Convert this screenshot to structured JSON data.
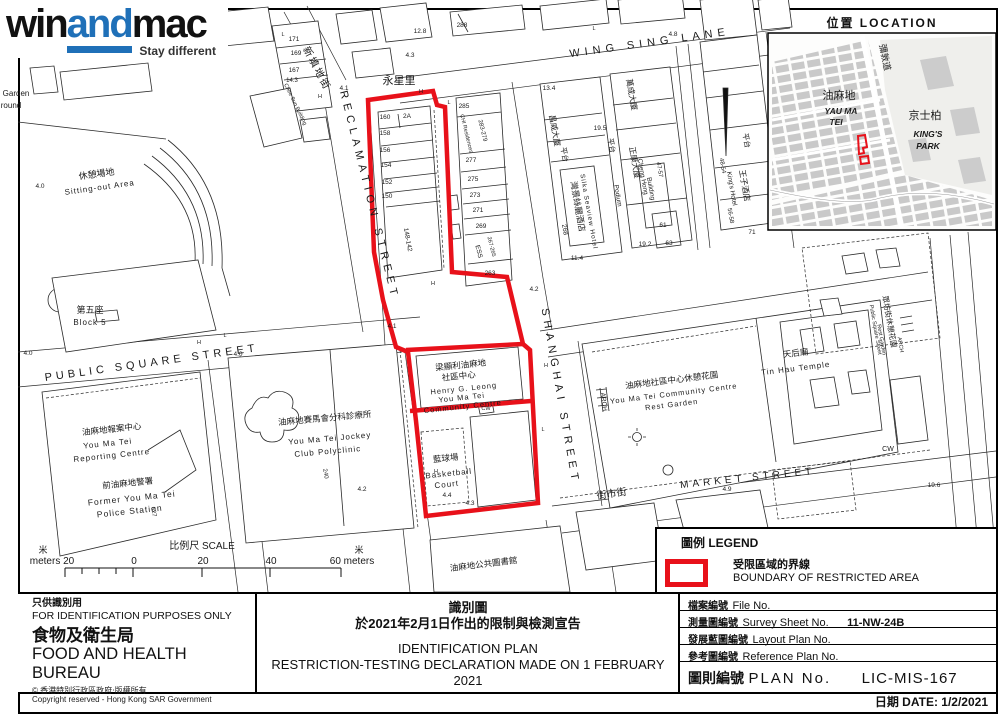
{
  "logo": {
    "win": "win",
    "and": "and",
    "mac": "mac",
    "tagline": "Stay different",
    "accent": "#1f70b8"
  },
  "inset": {
    "title": "位置  LOCATION",
    "labels": [
      {
        "t": "油麻地",
        "x": 839,
        "y": 99,
        "s": 11
      },
      {
        "t": "YAU  MA",
        "x": 841,
        "y": 114,
        "s": 8.5,
        "i": 1,
        "w": 1
      },
      {
        "t": "TEI",
        "x": 836,
        "y": 125,
        "s": 8.5,
        "i": 1,
        "w": 1
      },
      {
        "t": "京士柏",
        "x": 925,
        "y": 119,
        "s": 11
      },
      {
        "t": "KING'S",
        "x": 928,
        "y": 137,
        "s": 8.5,
        "i": 1,
        "w": 1
      },
      {
        "t": "PARK",
        "x": 928,
        "y": 149,
        "s": 8.5,
        "i": 1,
        "w": 1
      },
      {
        "t": "彌敦道",
        "x": 882,
        "y": 58,
        "r": 78,
        "s": 9
      }
    ]
  },
  "legend": {
    "title": "圖例 LEGEND",
    "item_zh": "受限區域的界線",
    "item_en": "BOUNDARY OF RESTRICTED AREA",
    "boundary_color": "#e8111a"
  },
  "titleblock": {
    "left": {
      "use_zh": "只供識別用",
      "use_en": "FOR IDENTIFICATION PURPOSES ONLY",
      "org_zh": "食物及衛生局",
      "org_en": "FOOD AND HEALTH BUREAU",
      "copyright_zh": "© 香港特別行政區政府‧版權所有",
      "copyright_en": "Copyright reserved - Hong Kong SAR Government"
    },
    "center": {
      "title_zh": "識別圖",
      "subtitle_zh": "於2021年2月1日作出的限制與檢測宣告",
      "title_en": "IDENTIFICATION PLAN",
      "subtitle_en": "RESTRICTION-TESTING DECLARATION MADE ON 1 FEBRUARY 2021"
    },
    "right": {
      "rows": [
        {
          "zh": "檔案編號",
          "en": "File  No.",
          "value": ""
        },
        {
          "zh": "測量圖編號",
          "en": "Survey  Sheet  No.",
          "value": "11-NW-24B"
        },
        {
          "zh": "發展藍圖編號",
          "en": "Layout  Plan  No.",
          "value": ""
        },
        {
          "zh": "參考圖編號",
          "en": "Reference  Plan  No.",
          "value": ""
        }
      ],
      "plan_zh": "圖則編號",
      "plan_en": "PLAN  No.",
      "plan_value": "LIC-MIS-167",
      "date_label": "日期   DATE:  1/2/2021"
    }
  },
  "map": {
    "labels": [
      {
        "t": "WING SING LANE",
        "x": 650,
        "y": 46,
        "r": -8,
        "s": 11,
        "ls": 5
      },
      {
        "t": "永星里",
        "x": 399,
        "y": 84,
        "s": 11
      },
      {
        "t": "新填地街",
        "x": 314,
        "y": 70,
        "r": 62,
        "s": 10,
        "ls": 2
      },
      {
        "t": "RECLAMATION STREET",
        "x": 366,
        "y": 196,
        "r": 76,
        "s": 11,
        "ls": 5
      },
      {
        "t": "SHANGHAI STREET",
        "x": 557,
        "y": 397,
        "r": 80,
        "s": 11,
        "ls": 5
      },
      {
        "t": "PUBLIC SQUARE STREET",
        "x": 152,
        "y": 366,
        "r": -8,
        "s": 11,
        "ls": 4
      },
      {
        "t": "MARKET STREET",
        "x": 748,
        "y": 481,
        "r": -6,
        "s": 10,
        "ls": 4
      },
      {
        "t": "街市街",
        "x": 612,
        "y": 497,
        "r": -8,
        "s": 10
      },
      {
        "t": "休憩場地",
        "x": 97,
        "y": 177,
        "r": -8,
        "s": 9
      },
      {
        "t": "Sitting-out Area",
        "x": 100,
        "y": 190,
        "r": -8,
        "s": 8,
        "ls": 1
      },
      {
        "t": "第五座",
        "x": 90,
        "y": 313,
        "s": 9
      },
      {
        "t": "Block 5",
        "x": 90,
        "y": 325,
        "s": 8,
        "ls": 1
      },
      {
        "t": "Garden",
        "x": 16,
        "y": 96,
        "s": 8
      },
      {
        "t": "round",
        "x": 11,
        "y": 108,
        "s": 8
      },
      {
        "t": "油麻地報案中心",
        "x": 112,
        "y": 432,
        "r": -6,
        "s": 8.5
      },
      {
        "t": "You Ma Tei",
        "x": 108,
        "y": 446,
        "r": -6,
        "s": 8,
        "ls": 1
      },
      {
        "t": "Reporting Centre",
        "x": 112,
        "y": 458,
        "r": -6,
        "s": 8,
        "ls": 1
      },
      {
        "t": "前油麻地警署",
        "x": 128,
        "y": 486,
        "r": -6,
        "s": 8.5
      },
      {
        "t": "Former You Ma Tei",
        "x": 132,
        "y": 501,
        "r": -6,
        "s": 8.5,
        "ls": 1
      },
      {
        "t": "Police Station",
        "x": 130,
        "y": 514,
        "r": -6,
        "s": 8.5,
        "ls": 1
      },
      {
        "t": "油麻地賽馬會分科診療所",
        "x": 325,
        "y": 421,
        "r": -5,
        "s": 8.5
      },
      {
        "t": "You Ma Tei Jockey",
        "x": 330,
        "y": 441,
        "r": -5,
        "s": 8,
        "ls": 1
      },
      {
        "t": "Club Polyclinic",
        "x": 328,
        "y": 454,
        "r": -5,
        "s": 8,
        "ls": 1
      },
      {
        "t": "梁顯利油麻地",
        "x": 461,
        "y": 368,
        "r": -6,
        "s": 8.5
      },
      {
        "t": "社區中心",
        "x": 459,
        "y": 379,
        "r": -6,
        "s": 8.5
      },
      {
        "t": "Henry G. Leong",
        "x": 464,
        "y": 391,
        "r": -6,
        "s": 7.5,
        "ls": 1
      },
      {
        "t": "You Ma Tei",
        "x": 462,
        "y": 400,
        "r": -6,
        "s": 7.5,
        "ls": 1
      },
      {
        "t": "Community Centre",
        "x": 463,
        "y": 409,
        "r": -6,
        "s": 7.5,
        "ls": 1
      },
      {
        "t": "藍球場",
        "x": 446,
        "y": 461,
        "r": -6,
        "s": 8.5
      },
      {
        "t": "Basketball",
        "x": 449,
        "y": 476,
        "r": -6,
        "s": 8,
        "ls": 1
      },
      {
        "t": "Court",
        "x": 447,
        "y": 487,
        "r": -6,
        "s": 8,
        "ls": 1
      },
      {
        "t": "4.4",
        "x": 447,
        "y": 497,
        "s": 6.5
      },
      {
        "t": "4.3",
        "x": 470,
        "y": 505,
        "s": 6.5
      },
      {
        "t": "油麻地社區中心休憩花園",
        "x": 672,
        "y": 383,
        "r": -7,
        "s": 8.5
      },
      {
        "t": "You Ma Tei Community Centre",
        "x": 674,
        "y": 396,
        "r": -7,
        "s": 7.5,
        "ls": 1
      },
      {
        "t": "Rest Garden",
        "x": 672,
        "y": 407,
        "r": -7,
        "s": 7.5,
        "ls": 1
      },
      {
        "t": "天后廟",
        "x": 796,
        "y": 356,
        "r": -7,
        "s": 8.5
      },
      {
        "t": "Tin Hau Temple",
        "x": 796,
        "y": 371,
        "r": -7,
        "s": 8,
        "ls": 1
      },
      {
        "t": "油麻地公共圖書館",
        "x": 484,
        "y": 567,
        "r": -7,
        "s": 8.5
      },
      {
        "t": "ARCH",
        "x": 602,
        "y": 402,
        "r": 84,
        "s": 6.5
      },
      {
        "t": "眾坊街休憩花園",
        "x": 887,
        "y": 322,
        "r": 80,
        "s": 7.5
      },
      {
        "t": "Public Square Street",
        "x": 874,
        "y": 330,
        "r": 80,
        "s": 5.5
      },
      {
        "t": "Rest Garden",
        "x": 880,
        "y": 340,
        "r": 80,
        "s": 5.5
      },
      {
        "t": "ARCH",
        "x": 899,
        "y": 345,
        "r": 80,
        "s": 5.5
      },
      {
        "t": "CW",
        "x": 888,
        "y": 451,
        "s": 7
      },
      {
        "t": "CW",
        "x": 486,
        "y": 410,
        "s": 5.5
      },
      {
        "t": "昌威大廈",
        "x": 552,
        "y": 131,
        "r": 80,
        "s": 8
      },
      {
        "t": "平台",
        "x": 562,
        "y": 155,
        "r": 80,
        "s": 7.5
      },
      {
        "t": "灣景絲麗酒店",
        "x": 575,
        "y": 207,
        "r": 80,
        "s": 8.5
      },
      {
        "t": "Silka Seaview Hotel",
        "x": 587,
        "y": 212,
        "r": 80,
        "s": 6.5,
        "ls": 1
      },
      {
        "t": "268",
        "x": 563,
        "y": 230,
        "r": 80,
        "s": 6.5
      },
      {
        "t": "13.4",
        "x": 549,
        "y": 90,
        "s": 6.5
      },
      {
        "t": "萬成大廈",
        "x": 629,
        "y": 95,
        "r": 80,
        "s": 8
      },
      {
        "t": "平台",
        "x": 609,
        "y": 146,
        "r": 80,
        "s": 7.5
      },
      {
        "t": "19.5",
        "x": 600,
        "y": 130,
        "s": 6.5
      },
      {
        "t": "正康大廈",
        "x": 632,
        "y": 163,
        "r": 80,
        "s": 8
      },
      {
        "t": "Cheng Hong",
        "x": 641,
        "y": 177,
        "r": 80,
        "s": 6.5
      },
      {
        "t": "Building",
        "x": 649,
        "y": 189,
        "r": 80,
        "s": 6.5
      },
      {
        "t": "47-57",
        "x": 658,
        "y": 170,
        "r": 80,
        "s": 6
      },
      {
        "t": "Podium",
        "x": 616,
        "y": 196,
        "r": 80,
        "s": 6.5
      },
      {
        "t": "61",
        "x": 663,
        "y": 227,
        "s": 6.5
      },
      {
        "t": "63",
        "x": 669,
        "y": 245,
        "s": 6.5
      },
      {
        "t": "19.2",
        "x": 645,
        "y": 246,
        "s": 6.5
      },
      {
        "t": "11.4",
        "x": 577,
        "y": 260,
        "s": 6.5
      },
      {
        "t": "平台",
        "x": 744,
        "y": 141,
        "r": 80,
        "s": 7.5
      },
      {
        "t": "王子酒店",
        "x": 742,
        "y": 186,
        "r": 80,
        "s": 8
      },
      {
        "t": "King's Hotel",
        "x": 730,
        "y": 189,
        "r": 80,
        "s": 6.5
      },
      {
        "t": "48-54",
        "x": 721,
        "y": 166,
        "r": 80,
        "s": 6
      },
      {
        "t": "56-58",
        "x": 729,
        "y": 216,
        "r": 80,
        "s": 6
      },
      {
        "t": "71",
        "x": 752,
        "y": 234,
        "s": 6.5
      },
      {
        "t": "160",
        "x": 385,
        "y": 119,
        "s": 6.5
      },
      {
        "t": "2A",
        "x": 407,
        "y": 118,
        "s": 6.5
      },
      {
        "t": "158",
        "x": 385,
        "y": 135,
        "s": 6.5
      },
      {
        "t": "156",
        "x": 385,
        "y": 152,
        "s": 6.5
      },
      {
        "t": "154",
        "x": 386,
        "y": 167,
        "s": 6.5
      },
      {
        "t": "152",
        "x": 387,
        "y": 184,
        "s": 6.5
      },
      {
        "t": "150",
        "x": 387,
        "y": 198,
        "s": 6.5
      },
      {
        "t": "148-142",
        "x": 406,
        "y": 240,
        "r": 80,
        "s": 6.5
      },
      {
        "t": "285",
        "x": 464,
        "y": 108,
        "s": 6.5
      },
      {
        "t": "283-279",
        "x": 481,
        "y": 131,
        "r": 76,
        "s": 6
      },
      {
        "t": "CHI Residences",
        "x": 465,
        "y": 134,
        "r": 76,
        "s": 5.5
      },
      {
        "t": "277",
        "x": 471,
        "y": 162,
        "s": 6.5
      },
      {
        "t": "275",
        "x": 473,
        "y": 181,
        "s": 6.5
      },
      {
        "t": "273",
        "x": 475,
        "y": 197,
        "s": 6.5
      },
      {
        "t": "271",
        "x": 478,
        "y": 212,
        "s": 6.5
      },
      {
        "t": "269",
        "x": 481,
        "y": 228,
        "s": 6.5
      },
      {
        "t": "267-265",
        "x": 490,
        "y": 247,
        "r": 76,
        "s": 5.5
      },
      {
        "t": "ESS",
        "x": 477,
        "y": 252,
        "r": 76,
        "s": 6.5
      },
      {
        "t": "263",
        "x": 490,
        "y": 275,
        "s": 6.5
      },
      {
        "t": "171",
        "x": 294,
        "y": 41,
        "s": 6.5
      },
      {
        "t": "169",
        "x": 296,
        "y": 55,
        "s": 6.5
      },
      {
        "t": "167",
        "x": 294,
        "y": 72,
        "s": 6.5
      },
      {
        "t": "14.3",
        "x": 292,
        "y": 82,
        "s": 6
      },
      {
        "t": "Chee Sun Building",
        "x": 294,
        "y": 105,
        "r": 64,
        "s": 5.5
      },
      {
        "t": "4.1",
        "x": 344,
        "y": 90,
        "s": 6.5
      },
      {
        "t": "12.8",
        "x": 420,
        "y": 33,
        "s": 6.5
      },
      {
        "t": "4.3",
        "x": 410,
        "y": 57,
        "s": 6.5
      },
      {
        "t": "288",
        "x": 462,
        "y": 27,
        "s": 6.5
      },
      {
        "t": "4.8",
        "x": 673,
        "y": 36,
        "s": 6.5
      },
      {
        "t": "4.2",
        "x": 534,
        "y": 291,
        "s": 6.5
      },
      {
        "t": "4.1",
        "x": 392,
        "y": 328,
        "s": 6.5
      },
      {
        "t": "4.0",
        "x": 40,
        "y": 188,
        "s": 6.5
      },
      {
        "t": "4.0",
        "x": 28,
        "y": 355,
        "s": 6.5
      },
      {
        "t": "4.0",
        "x": 238,
        "y": 356,
        "s": 6.5
      },
      {
        "t": "4.2",
        "x": 362,
        "y": 491,
        "s": 6.5
      },
      {
        "t": "240",
        "x": 324,
        "y": 474,
        "r": 80,
        "s": 6
      },
      {
        "t": "627",
        "x": 152,
        "y": 512,
        "r": 80,
        "s": 6
      },
      {
        "t": "4.9",
        "x": 727,
        "y": 491,
        "s": 6.5
      },
      {
        "t": "19.6",
        "x": 934,
        "y": 487,
        "s": 6.5
      },
      {
        "t": "L",
        "x": 283,
        "y": 36,
        "s": 5.5
      },
      {
        "t": "H",
        "x": 320,
        "y": 98,
        "s": 5.5
      },
      {
        "t": "H",
        "x": 421,
        "y": 93,
        "s": 5.5
      },
      {
        "t": "L",
        "x": 449,
        "y": 104,
        "s": 5.5
      },
      {
        "t": "H",
        "x": 199,
        "y": 344,
        "s": 5.5
      },
      {
        "t": "L",
        "x": 225,
        "y": 337,
        "s": 5.5
      },
      {
        "t": "H",
        "x": 546,
        "y": 367,
        "s": 5.5
      },
      {
        "t": "L",
        "x": 548,
        "y": 336,
        "s": 5.5
      },
      {
        "t": "H",
        "x": 436,
        "y": 473,
        "s": 5.5
      },
      {
        "t": "L",
        "x": 543,
        "y": 431,
        "s": 5.5
      },
      {
        "t": "L",
        "x": 594,
        "y": 30,
        "s": 5.5
      },
      {
        "t": "H",
        "x": 433,
        "y": 285,
        "s": 5.5
      },
      {
        "t": "米",
        "x": 43,
        "y": 553,
        "s": 9
      },
      {
        "t": "meters 20",
        "x": 52,
        "y": 564,
        "s": 10
      },
      {
        "t": "0",
        "x": 134,
        "y": 564,
        "s": 10
      },
      {
        "t": "比例尺  SCALE",
        "x": 202,
        "y": 549,
        "s": 10
      },
      {
        "t": "20",
        "x": 203,
        "y": 564,
        "s": 10
      },
      {
        "t": "40",
        "x": 271,
        "y": 564,
        "s": 10
      },
      {
        "t": "60 meters",
        "x": 352,
        "y": 564,
        "s": 10
      },
      {
        "t": "米",
        "x": 359,
        "y": 553,
        "s": 9
      }
    ]
  }
}
